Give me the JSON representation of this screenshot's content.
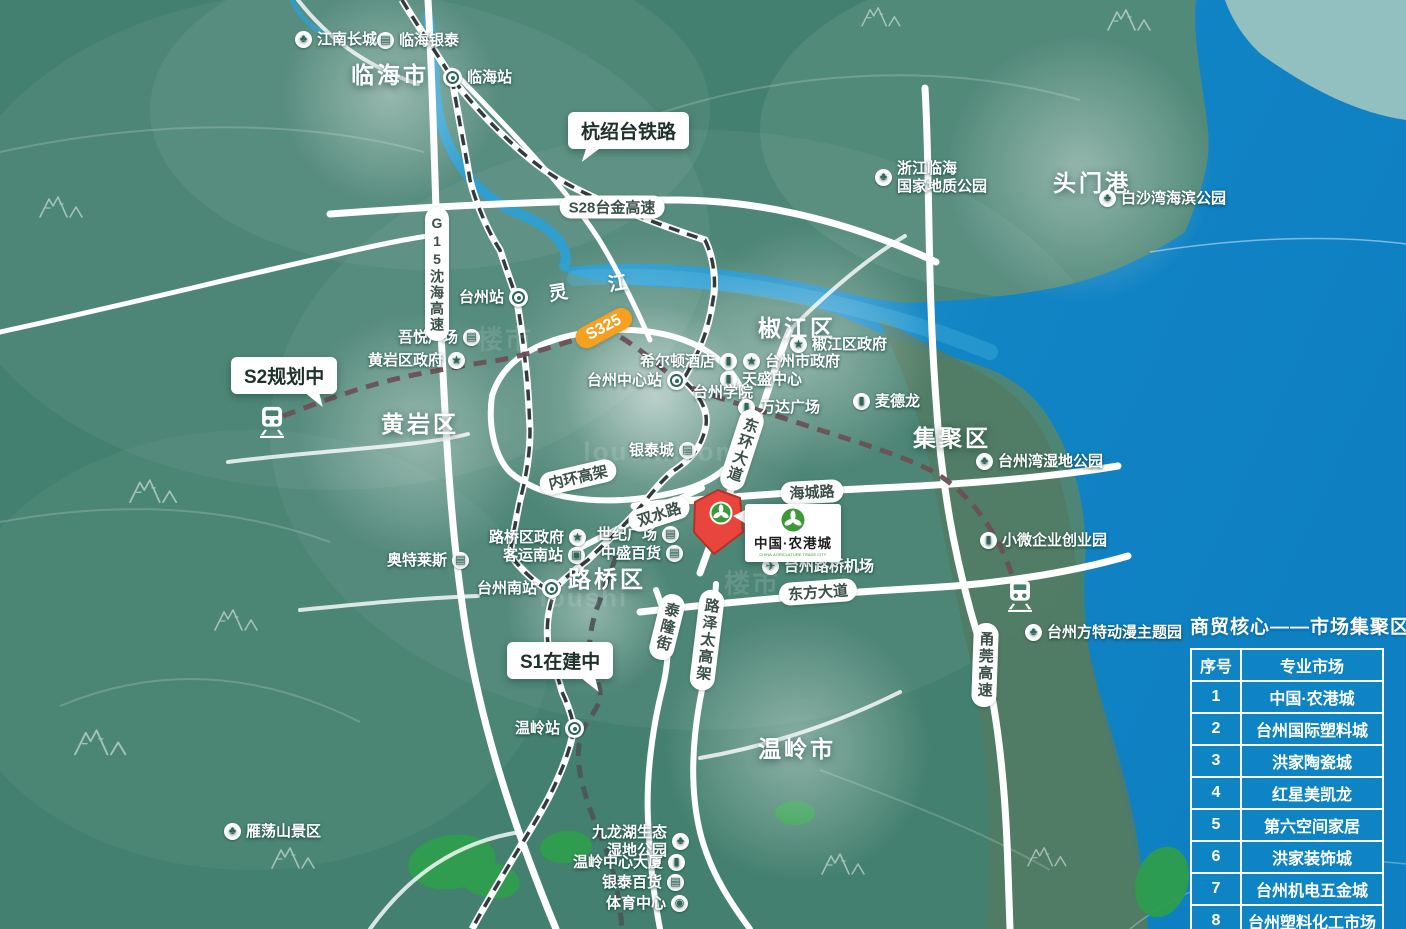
{
  "regions": {
    "districts": [
      {
        "id": "linhai",
        "label": "临海市"
      },
      {
        "id": "huangyan",
        "label": "黄岩区"
      },
      {
        "id": "jiaojiang",
        "label": "椒江区"
      },
      {
        "id": "jiju",
        "label": "集聚区"
      },
      {
        "id": "luqiao",
        "label": "路桥区"
      },
      {
        "id": "wenling",
        "label": "温岭市"
      },
      {
        "id": "toumengang",
        "label": "头门港"
      }
    ],
    "river": {
      "id": "lingjiang",
      "label": "灵 江"
    }
  },
  "pois": [
    {
      "id": "jiangnan-greatwall",
      "label": "江南长城",
      "icon": "tree"
    },
    {
      "id": "linhai-yintai",
      "label": "临海银泰",
      "icon": "shop"
    },
    {
      "id": "linhai-station",
      "label": "临海站",
      "icon": "station"
    },
    {
      "id": "linhai-geopark",
      "label": "浙江临海\n国家地质公园",
      "icon": "tree"
    },
    {
      "id": "baishawan-park",
      "label": "白沙湾海滨公园",
      "icon": "tree"
    },
    {
      "id": "taizhou-station",
      "label": "台州站",
      "icon": "station"
    },
    {
      "id": "wuyue-plaza",
      "label": "吾悦广场",
      "icon": "shop"
    },
    {
      "id": "huangyan-gov",
      "label": "黄岩区政府",
      "icon": "star"
    },
    {
      "id": "hilton-hotel",
      "label": "希尔顿酒店",
      "icon": "building"
    },
    {
      "id": "taizhou-center-station",
      "label": "台州中心站",
      "icon": "station"
    },
    {
      "id": "tiansheng-center",
      "label": "天盛中心",
      "icon": "building"
    },
    {
      "id": "taizhou-gov",
      "label": "台州市政府",
      "icon": "star"
    },
    {
      "id": "jiaojiang-gov",
      "label": "椒江区政府",
      "icon": "star"
    },
    {
      "id": "taizhou-college",
      "label": "台州学院",
      "icon": "none"
    },
    {
      "id": "wanda-plaza",
      "label": "万达广场",
      "icon": "building"
    },
    {
      "id": "metro-market",
      "label": "麦德龙",
      "icon": "building"
    },
    {
      "id": "taizhouwan-wetland",
      "label": "台州湾湿地公园",
      "icon": "tree"
    },
    {
      "id": "yintai-city",
      "label": "银泰城",
      "icon": "shop"
    },
    {
      "id": "century-plaza",
      "label": "世纪广场",
      "icon": "shop"
    },
    {
      "id": "zhongsheng-dept",
      "label": "中盛百货",
      "icon": "shop"
    },
    {
      "id": "luqiao-gov",
      "label": "路桥区政府",
      "icon": "star"
    },
    {
      "id": "south-bus-station",
      "label": "客运南站",
      "icon": "bus"
    },
    {
      "id": "outlets",
      "label": "奥特莱斯",
      "icon": "shop"
    },
    {
      "id": "taizhou-south-station",
      "label": "台州南站",
      "icon": "station"
    },
    {
      "id": "luqiao-airport",
      "label": "台州路桥机场",
      "icon": "plane"
    },
    {
      "id": "micro-enterprise-park",
      "label": "小微企业创业园",
      "icon": "building"
    },
    {
      "id": "fantawild",
      "label": "台州方特动漫主题园",
      "icon": "tree"
    },
    {
      "id": "wenling-station",
      "label": "温岭站",
      "icon": "station"
    },
    {
      "id": "jiulonghu-wetland",
      "label": "九龙湖生态\n湿地公园",
      "icon": "tree"
    },
    {
      "id": "wenling-tower",
      "label": "温岭中心大厦",
      "icon": "building"
    },
    {
      "id": "yintai-dept",
      "label": "银泰百货",
      "icon": "shop"
    },
    {
      "id": "sports-center",
      "label": "体育中心",
      "icon": "soccer"
    },
    {
      "id": "yandangshan",
      "label": "雁荡山景区",
      "icon": "tree"
    }
  ],
  "road_labels": [
    {
      "id": "s28",
      "label": "S28台金高速"
    },
    {
      "id": "g15",
      "label": "G15沈海高速"
    },
    {
      "id": "s325",
      "label": "S325"
    },
    {
      "id": "neihuan",
      "label": "内环高架"
    },
    {
      "id": "donghuan",
      "label": "东环大道"
    },
    {
      "id": "haicheng",
      "label": "海城路"
    },
    {
      "id": "shuangshui",
      "label": "双水路"
    },
    {
      "id": "dongfang",
      "label": "东方大道"
    },
    {
      "id": "tailong",
      "label": "泰隆街"
    },
    {
      "id": "luzetai",
      "label": "路泽太高架"
    },
    {
      "id": "yongguan",
      "label": "甬莞高速"
    }
  ],
  "callouts": [
    {
      "id": "hangshaotai-railway",
      "label": "杭绍台铁路"
    },
    {
      "id": "s2-planned",
      "label": "S2规划中"
    },
    {
      "id": "s1-under-construction",
      "label": "S1在建中"
    }
  ],
  "landmark_card": {
    "name": "中国·农港城",
    "name_en": "CHINA·AGRICULTURE TRADE CITY"
  },
  "market_table": {
    "title": "商贸核心——市场集聚区",
    "headers": [
      "序号",
      "专业市场"
    ],
    "rows": [
      [
        "1",
        "中国·农港城"
      ],
      [
        "2",
        "台州国际塑料城"
      ],
      [
        "3",
        "洪家陶瓷城"
      ],
      [
        "4",
        "红星美凯龙"
      ],
      [
        "5",
        "第六空间家居"
      ],
      [
        "6",
        "洪家装饰城"
      ],
      [
        "7",
        "台州机电五金城"
      ],
      [
        "8",
        "台州塑料化工市场"
      ]
    ]
  },
  "watermarks": [
    "楼市",
    "loushi.com",
    "楼市",
    "loushi"
  ],
  "colors": {
    "land": "#44806F",
    "land_dark": "#527A63",
    "land_pale": "#A9CABE",
    "sea": "#1184C4",
    "sea_light": "#2FA3D3",
    "road": "#FFFFFF",
    "railway": "#343B3E",
    "metro_s2": "#6B5156",
    "metro_s1": "#4E5558",
    "route_badge": "#F5A021",
    "landmark_red": "#E8463C",
    "logo_green": "#3C9A35",
    "table_blue": "#0E84C4",
    "park_green": "#2F9E4D"
  }
}
